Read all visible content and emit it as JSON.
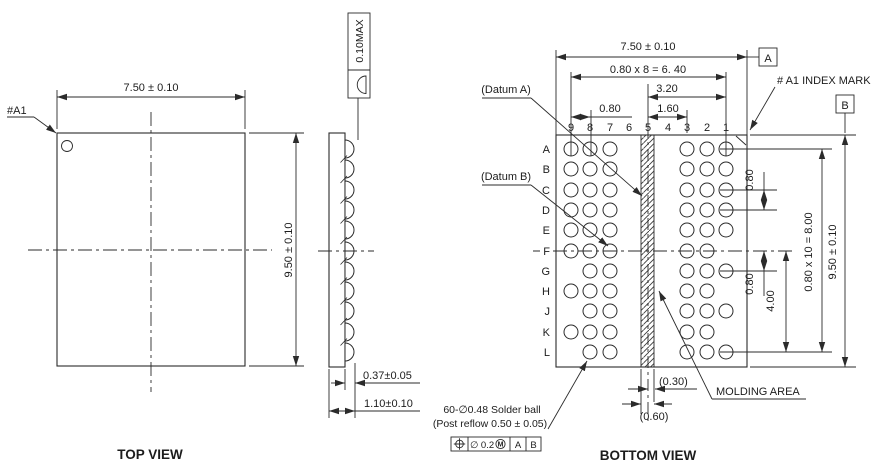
{
  "top_view": {
    "title": "TOP VIEW",
    "a1_label": "#A1",
    "width_dim": "7.50 ± 0.10",
    "height_dim": "9.50 ± 0.10"
  },
  "side_view": {
    "coplanarity_callout": "0.10MAX",
    "standoff_dim": "0.37±0.05",
    "thickness_dim": "1.10±0.10"
  },
  "bottom_view": {
    "title": "BOTTOM VIEW",
    "width_dim": "7.50 ± 0.10",
    "height_dim": "9.50 ± 0.10",
    "ball_span_h_dim": "0.80 x 8 = 6. 40",
    "half_span_dim": "3.20",
    "pitch_dim_h": "0.80",
    "double_pitch_dim": "1.60",
    "pitch_dim_v_upper": "0.80",
    "pitch_dim_v_lower": "0.80",
    "quad_span_dim": "4.00",
    "ball_span_v_dim": "0.80 x 10 = 8.00",
    "molding_half_dim": "(0.30)",
    "molding_full_dim": "(0.60)",
    "datum_a_note": "(Datum A)",
    "datum_b_note": "(Datum B)",
    "datum_a_flag": "A",
    "datum_b_flag": "B",
    "index_mark_note": "# A1 INDEX MARK",
    "molding_area_note": "MOLDING AREA",
    "solder_ball_note_line1": "60-∅0.48 Solder ball",
    "solder_ball_note_line2": "(Post reflow 0.50 ± 0.05)",
    "position_tolerance": {
      "symbol": "position",
      "value": "∅ 0.2",
      "modifier": "M",
      "datum_ref_1": "A",
      "datum_ref_2": "B"
    },
    "ball_grid": {
      "column_labels": [
        "9",
        "8",
        "7",
        "6",
        "5",
        "4",
        "3",
        "2",
        "1"
      ],
      "row_labels": [
        "A",
        "B",
        "C",
        "D",
        "E",
        "F",
        "G",
        "H",
        "J",
        "K",
        "L"
      ],
      "ball_columns": [
        "9",
        "8",
        "7",
        "3",
        "2",
        "1"
      ],
      "missing_balls": [
        "G9",
        "J9",
        "L9",
        "F1",
        "H1",
        "K1"
      ],
      "total_balls": 60
    }
  }
}
